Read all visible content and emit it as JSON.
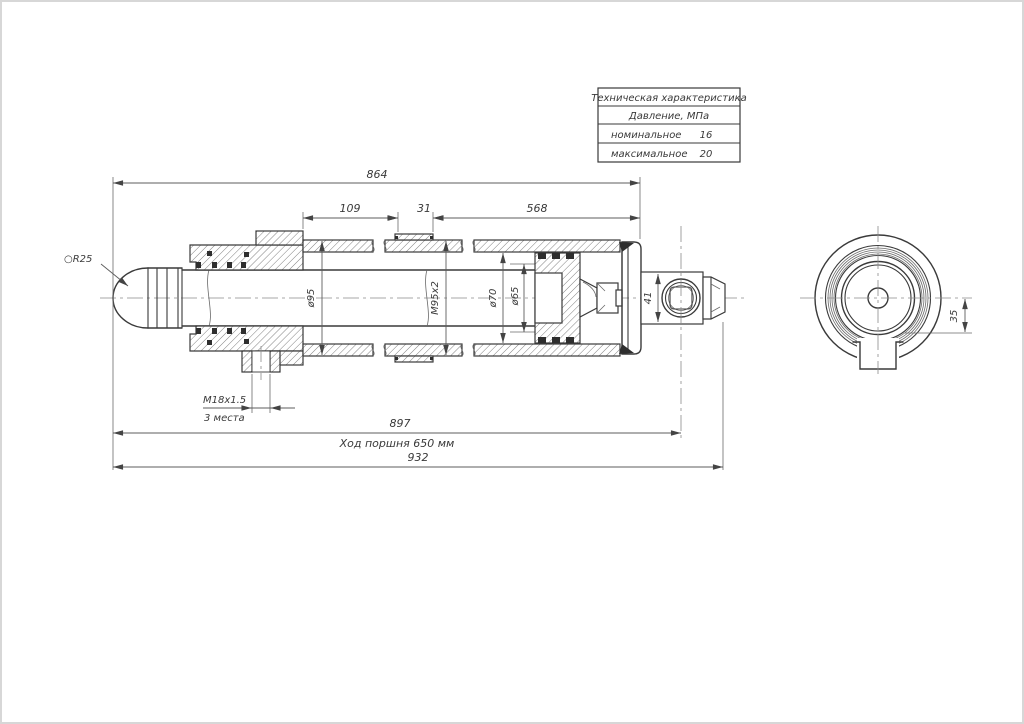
{
  "table": {
    "title": "Техническая характеристика",
    "subtitle": "Давление, МПа",
    "rows": [
      {
        "label": "номинальное",
        "value": "16"
      },
      {
        "label": "максимальное",
        "value": "20"
      }
    ]
  },
  "dimensions": {
    "overall_864": "864",
    "front_109": "109",
    "ring_31": "31",
    "rear_568": "568",
    "port_thread": "M18x1.5",
    "port_places": "3 места",
    "length_897": "897",
    "stroke_note": "Ход поршня 650 мм",
    "length_932": "932",
    "sphere_radius": "○R25",
    "barrel_diameter": "ø95",
    "barrel_thread": "M95x2",
    "bore_70": "ø70",
    "bore_65": "ø65",
    "eye_width": "41",
    "side_offset": "35"
  }
}
